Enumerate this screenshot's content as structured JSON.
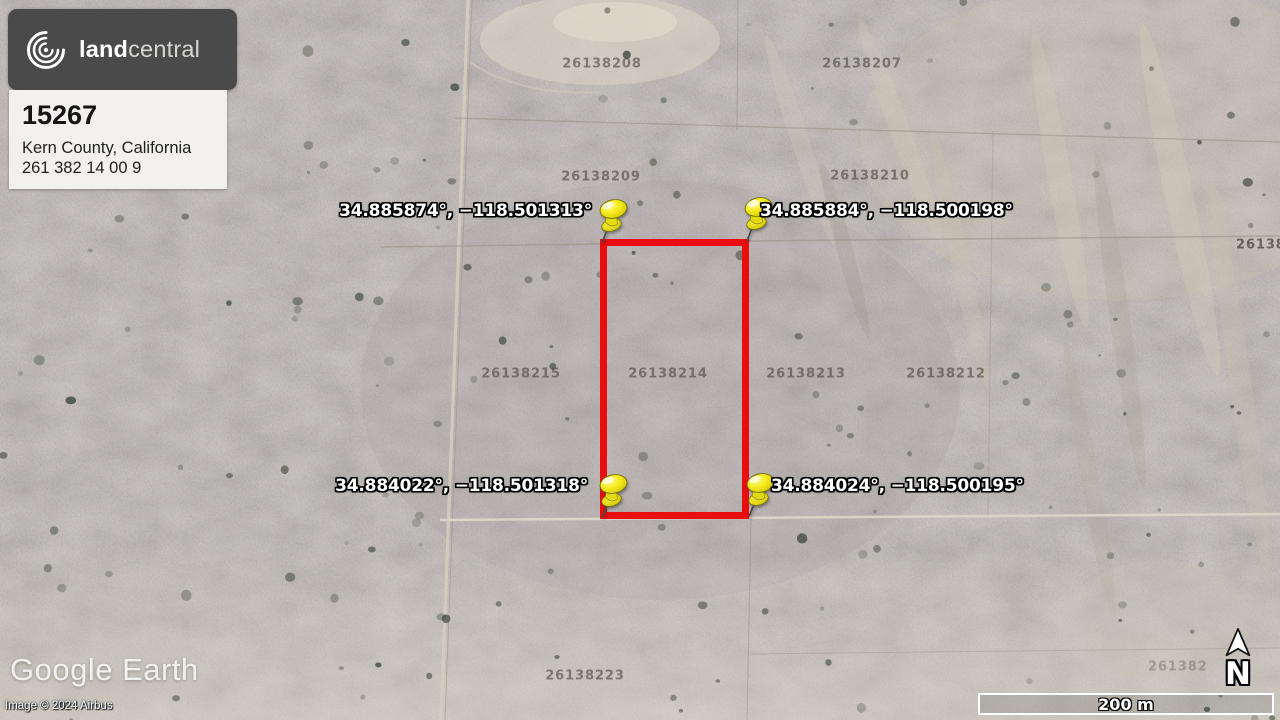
{
  "branding_card": {
    "logo_text_bold": "land",
    "logo_text_light": "central",
    "listing_id": "15267",
    "location": "Kern County, California",
    "apn": "261 382 14 00 9"
  },
  "map": {
    "provider_label": "Google Earth",
    "attribution": "Image © 2024 Airbus",
    "scale_label": "200 m",
    "north_label": "N",
    "boundary_color": "#e90d0d",
    "pin_color": "#f2e713"
  },
  "corner_labels": [
    {
      "corner": "top-left",
      "text": "34.885874°, −118.501313°"
    },
    {
      "corner": "top-right",
      "text": "34.885884°, −118.500198°"
    },
    {
      "corner": "bottom-left",
      "text": "34.884022°, −118.501318°"
    },
    {
      "corner": "bottom-right",
      "text": "34.884024°, −118.500195°"
    }
  ],
  "parcel_numbers": [
    {
      "text": "26138208"
    },
    {
      "text": "26138207"
    },
    {
      "text": "26138209"
    },
    {
      "text": "26138210"
    },
    {
      "text": "26138215"
    },
    {
      "text": "26138214"
    },
    {
      "text": "26138213"
    },
    {
      "text": "26138212"
    },
    {
      "text": "26138223"
    },
    {
      "text": "261382"
    },
    {
      "text": "261382"
    }
  ]
}
